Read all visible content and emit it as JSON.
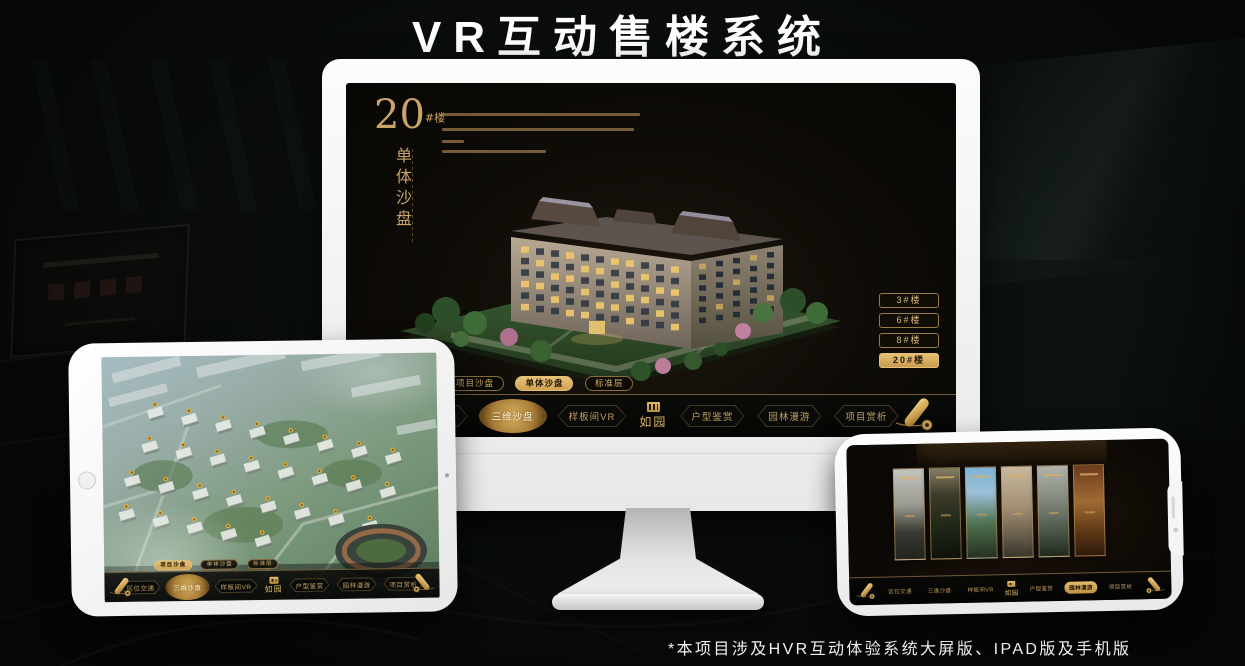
{
  "page": {
    "title": "VR互动售楼系统",
    "footnote": "*本项目涉及HVR互动体验系统大屏版、IPAD版及手机版"
  },
  "colors": {
    "gold": "#c9a469",
    "gold_bright": "#e6c27a",
    "gold_selected_bg": "#d8b168",
    "screen_black": "#0b0a08",
    "device_frame_white": "#f4f4f4"
  },
  "desktop_app": {
    "heading": {
      "number": "20",
      "suffix": "#楼",
      "vertical_title": "单体沙盘"
    },
    "building_tabs": [
      {
        "label": "3#楼",
        "selected": false
      },
      {
        "label": "6#楼",
        "selected": false
      },
      {
        "label": "8#楼",
        "selected": false
      },
      {
        "label": "20#楼",
        "selected": true
      }
    ],
    "floor_tabs": [
      {
        "label": "项目沙盘",
        "selected": false
      },
      {
        "label": "单体沙盘",
        "selected": true
      },
      {
        "label": "标准层",
        "selected": false
      }
    ],
    "nav": {
      "logo": "如园",
      "items": [
        {
          "label": "区位交通",
          "selected": false
        },
        {
          "label": "三维沙盘",
          "selected": true
        },
        {
          "label": "样板间VR",
          "selected": false
        },
        {
          "label": "户型鉴赏",
          "selected": false
        },
        {
          "label": "园林漫游",
          "selected": false
        },
        {
          "label": "项目赏析",
          "selected": false
        }
      ]
    }
  },
  "tablet_app": {
    "floor_tabs": [
      {
        "label": "项目沙盘",
        "selected": true
      },
      {
        "label": "单体沙盘",
        "selected": false
      },
      {
        "label": "标准层",
        "selected": false
      }
    ],
    "nav": {
      "logo": "如园",
      "items": [
        {
          "label": "区位交通",
          "selected": false
        },
        {
          "label": "三维沙盘",
          "selected": true
        },
        {
          "label": "样板间VR",
          "selected": false
        },
        {
          "label": "户型鉴赏",
          "selected": false
        },
        {
          "label": "园林漫游",
          "selected": false
        },
        {
          "label": "项目赏析",
          "selected": false
        }
      ]
    }
  },
  "phone_app": {
    "gallery": {
      "panel_count": 6
    },
    "nav": {
      "logo": "如园",
      "items": [
        {
          "label": "区位交通",
          "selected": false
        },
        {
          "label": "三维沙盘",
          "selected": false
        },
        {
          "label": "样板间VR",
          "selected": false
        },
        {
          "label": "户型鉴赏",
          "selected": false
        },
        {
          "label": "园林漫游",
          "selected": true
        },
        {
          "label": "项目赏析",
          "selected": false
        }
      ]
    }
  }
}
